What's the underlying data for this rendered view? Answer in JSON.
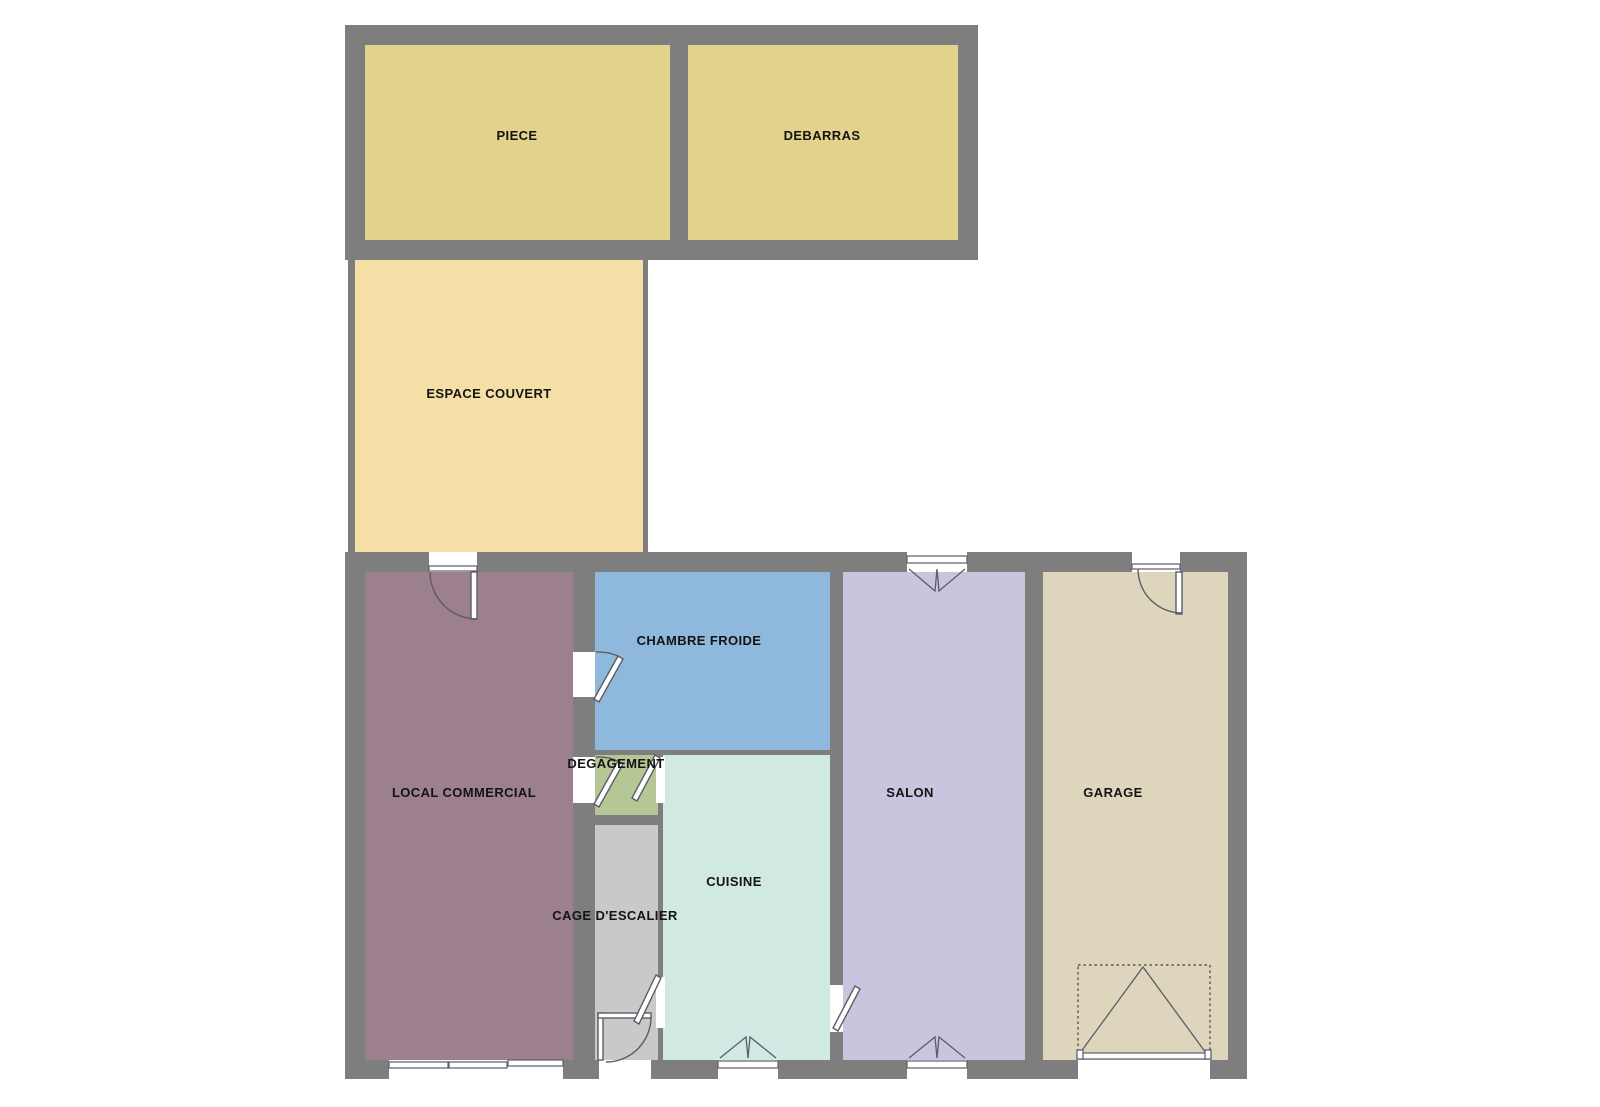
{
  "plan": {
    "background": "#ffffff",
    "wall_color": "#7e7e7e",
    "line_color": "#5c5c66",
    "rooms": {
      "piece": {
        "label": "PIECE",
        "color": "#e3d28b"
      },
      "debarras": {
        "label": "DEBARRAS",
        "color": "#e3d28b"
      },
      "espace_couvert": {
        "label": "ESPACE COUVERT",
        "color": "#f6dfa6"
      },
      "local_commercial": {
        "label": "LOCAL COMMERCIAL",
        "color": "#9d8090"
      },
      "chambre_froide": {
        "label": "CHAMBRE FROIDE",
        "color": "#8fb9dc"
      },
      "degagement": {
        "label": "DEGAGEMENT",
        "color": "#b5c795"
      },
      "cuisine": {
        "label": "CUISINE",
        "color": "#d0e9e3"
      },
      "cage_escalier": {
        "label": "CAGE D'ESCALIER",
        "color": "#c9c9c9"
      },
      "salon": {
        "label": "SALON",
        "color": "#cbc4de"
      },
      "garage": {
        "label": "GARAGE",
        "color": "#ded5bd"
      }
    }
  }
}
